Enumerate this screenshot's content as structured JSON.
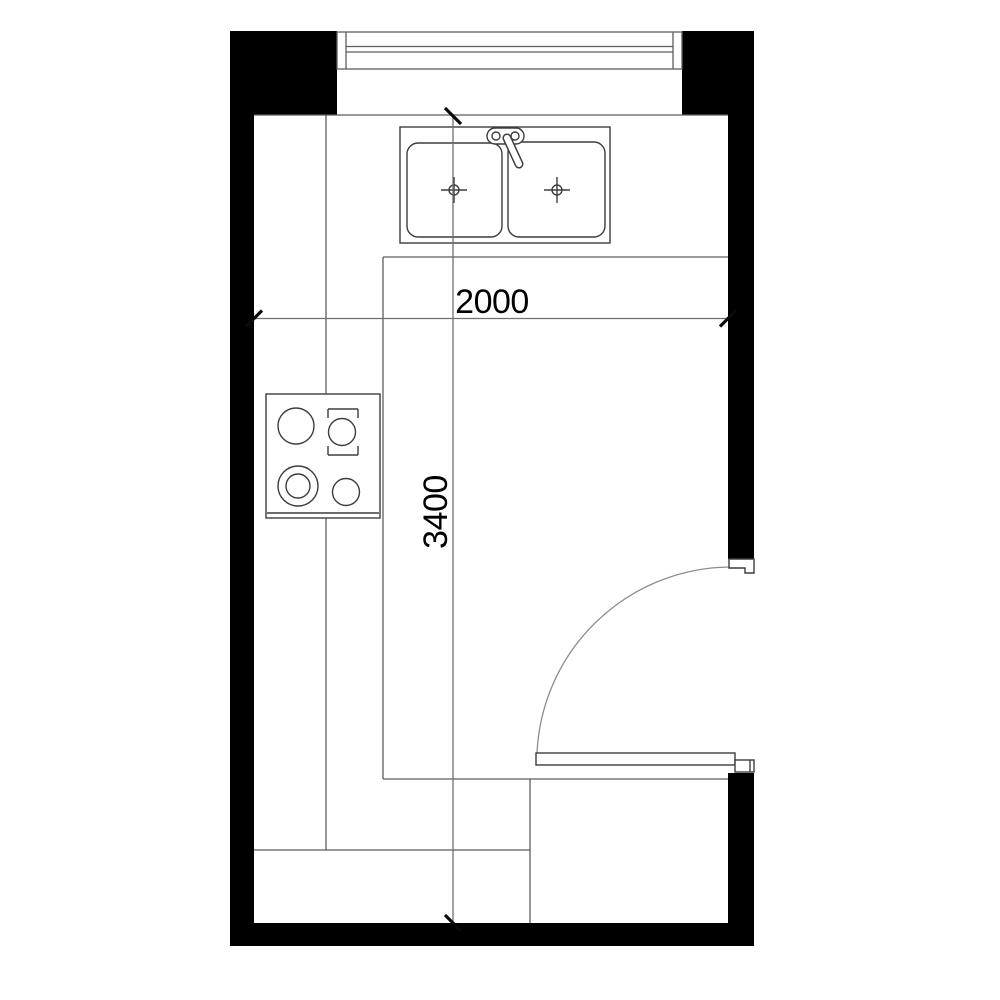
{
  "plan": {
    "dimension_width_label": "2000",
    "dimension_height_label": "3400"
  },
  "fixture_icons": {
    "window_icon": "triple-line window symbol in top wall",
    "sink_icon": "double-bowl sink with faucet",
    "cooktop_icon": "four-burner cooktop",
    "door_icon": "hinged door leaf with quarter-circle swing arc"
  },
  "colors": {
    "wall": "#000000",
    "fixture_line": "#3d3d3d",
    "counter_line": "#5e5e5e",
    "dim_line": "#707070",
    "arc_line": "#8c8c8c",
    "tick": "#0a0a0a",
    "text": "#000000",
    "background": "#ffffff"
  }
}
